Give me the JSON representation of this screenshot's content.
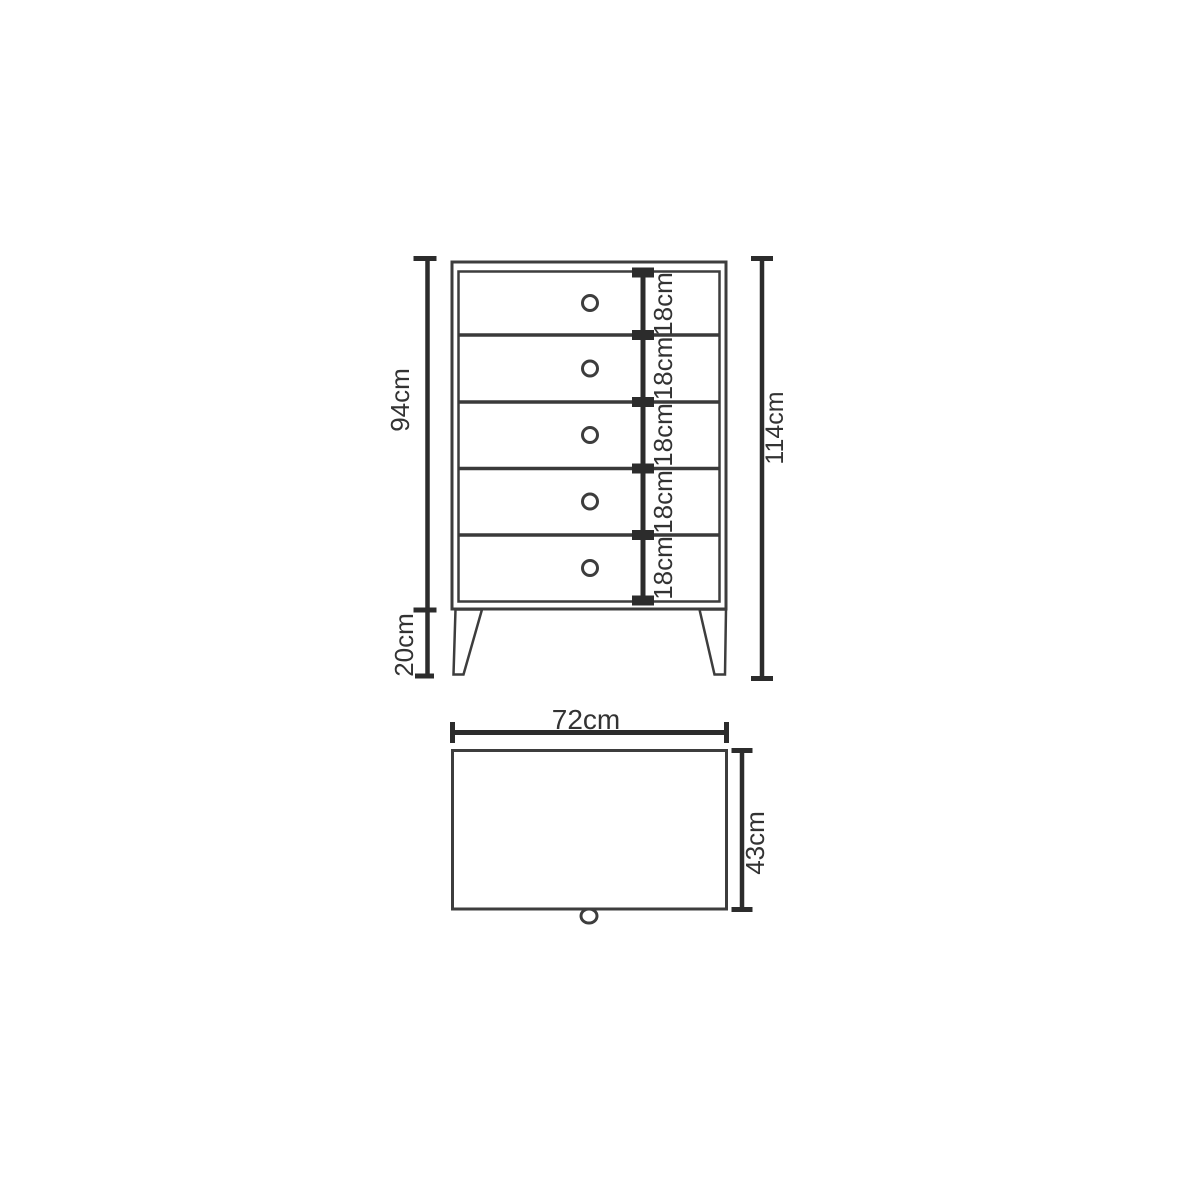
{
  "page": {
    "background": "#ffffff"
  },
  "colors": {
    "outline": "#3d3d3d",
    "dimension": "#2c2c2c",
    "label": "#333333"
  },
  "front_view": {
    "drawer_count": 5,
    "drawer_height_labels": [
      "18cm",
      "18cm",
      "18cm",
      "18cm",
      "18cm"
    ],
    "body_height_label": "94cm",
    "leg_height_label": "20cm",
    "total_height_label": "114cm"
  },
  "top_view": {
    "width_label": "72cm",
    "depth_label": "43cm"
  }
}
